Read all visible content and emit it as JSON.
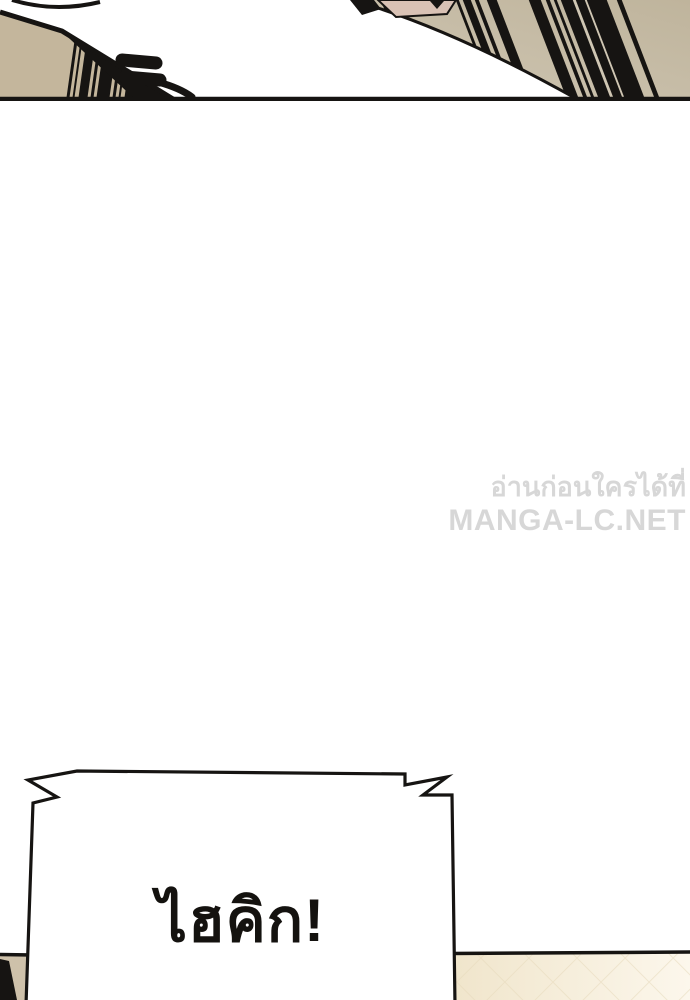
{
  "page": {
    "type": "manga-webtoon-page"
  },
  "watermark": {
    "line1": "อ่านก่อนใครได้ที่",
    "line2": "MANGA-LC.NET"
  },
  "speech_bubble": {
    "text": "ไฮคิก!"
  },
  "colors": {
    "ink": "#161412",
    "paper": "#ffffff",
    "tan_light": "#cfc6b3",
    "tan_dark": "#bfb49c",
    "beige": "#c4b69c",
    "beige_dark": "#cec1aa",
    "skin": "#d9c2b5",
    "cream_dark": "#f0e5cb",
    "cream_light": "#fcf7ec",
    "lattice": "#e6d9bb",
    "watermark": "#d7d7d7",
    "bubble_fill": "#ffffff",
    "text_ink": "#14120f"
  }
}
